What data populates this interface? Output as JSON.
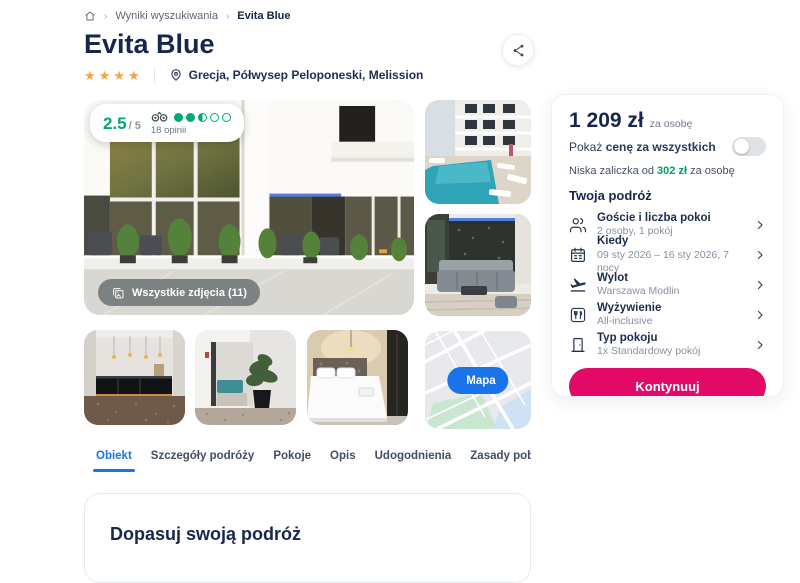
{
  "breadcrumb": {
    "level1": "Wyniki wyszukiwania",
    "level2": "Evita Blue"
  },
  "header": {
    "title": "Evita Blue",
    "stars": 4,
    "location": "Grecja, Półwysep Peloponeski, Melission"
  },
  "rating": {
    "score": "2.5",
    "scale": "/ 5",
    "reviews": "18 opinii",
    "dots": {
      "full": 2,
      "half": 1,
      "empty": 2
    }
  },
  "gallery": {
    "all_photos": "Wszystkie zdjęcia (11)",
    "map_button": "Mapa"
  },
  "booking": {
    "price": "1 209 zł",
    "price_suffix": "za osobę",
    "toggle_text": "Pokaż ",
    "toggle_text_bold": "cenę za wszystkich",
    "toggle_state": "off",
    "deposit_prefix": "Niska zaliczka od ",
    "deposit_amount": "302 zł",
    "deposit_suffix": " za osobę",
    "section_title": "Twoja podróż",
    "items": [
      {
        "icon": "guests-icon",
        "title": "Goście i liczba pokoi",
        "value": "2 osoby, 1 pokój"
      },
      {
        "icon": "calendar-icon",
        "title": "Kiedy",
        "value": "09 sty 2026 – 16 sty 2026, 7 nocy"
      },
      {
        "icon": "plane-icon",
        "title": "Wylot",
        "value": "Warszawa Modlin"
      },
      {
        "icon": "meals-icon",
        "title": "Wyżywienie",
        "value": "All-inclusive"
      },
      {
        "icon": "room-icon",
        "title": "Typ pokoju",
        "value": "1x Standardowy pokój"
      }
    ],
    "cta": "Kontynuuj"
  },
  "tabs": {
    "active_index": 0,
    "items": [
      "Obiekt",
      "Szczegóły podróży",
      "Pokoje",
      "Opis",
      "Udogodnienia",
      "Zasady pobytu"
    ]
  },
  "content": {
    "section_title": "Dopasuj swoją podróż"
  },
  "colors": {
    "accent_pink": "#e20a66",
    "accent_blue": "#1a73e8",
    "rating_green": "#00aa6c",
    "deposit_green": "#00a05f",
    "star_orange": "#f2a541",
    "navy": "#16264c"
  }
}
